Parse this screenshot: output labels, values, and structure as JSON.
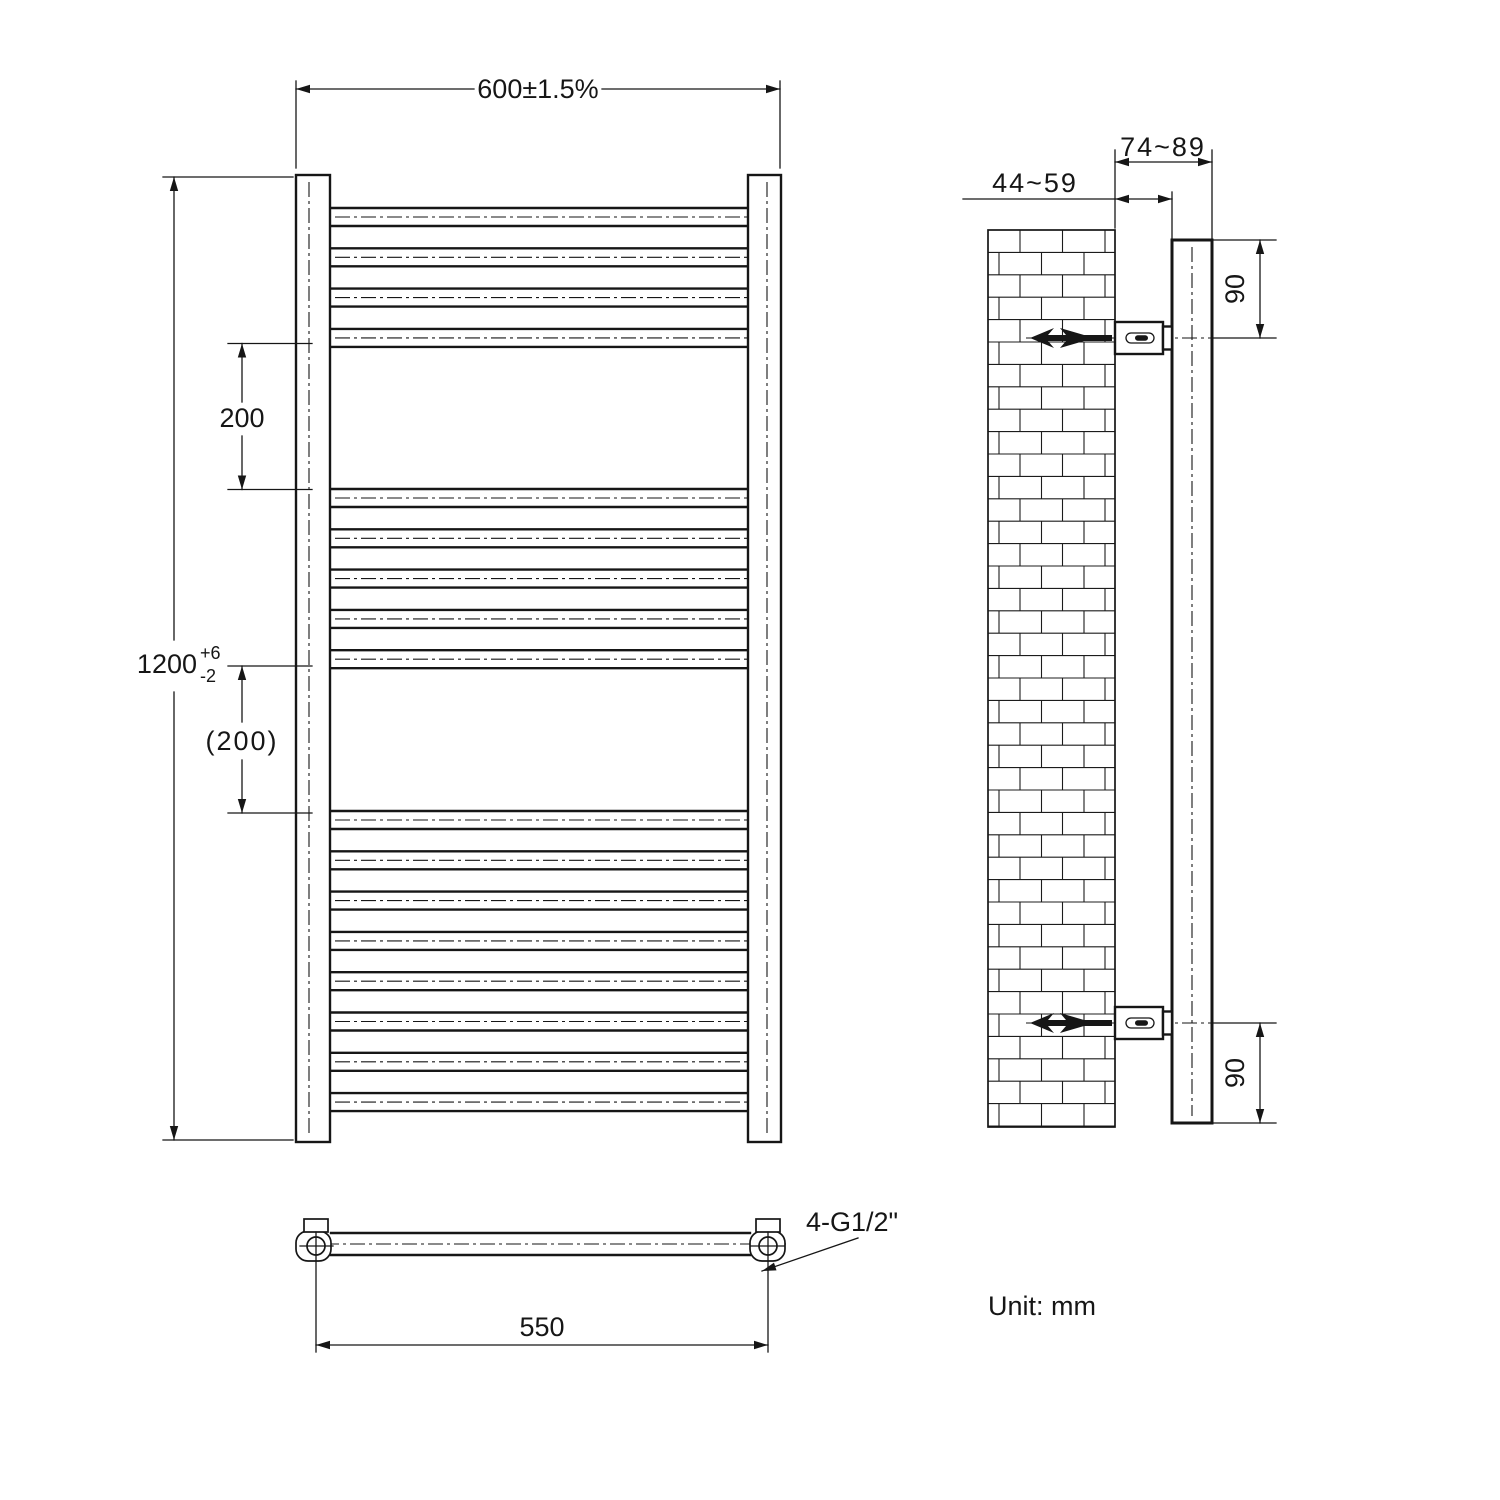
{
  "drawing": {
    "unit_label": "Unit: mm",
    "front_view": {
      "width_dim": "600±1.5%",
      "height_dim_value": "1200",
      "height_dim_upper_tol": "+6",
      "height_dim_lower_tol": "-2",
      "rung_gap_dim": "200",
      "rung_gap_dim_ref": "(200)",
      "rung_groups": [
        4,
        5,
        8
      ]
    },
    "side_view": {
      "wall_clearance_dim": "44~59",
      "overall_depth_dim": "74~89",
      "top_bracket_offset_dim": "90",
      "bottom_bracket_offset_dim": "90"
    },
    "bottom_view": {
      "connection_pitch_dim": "550",
      "thread_label": "4-G1/2\""
    }
  }
}
